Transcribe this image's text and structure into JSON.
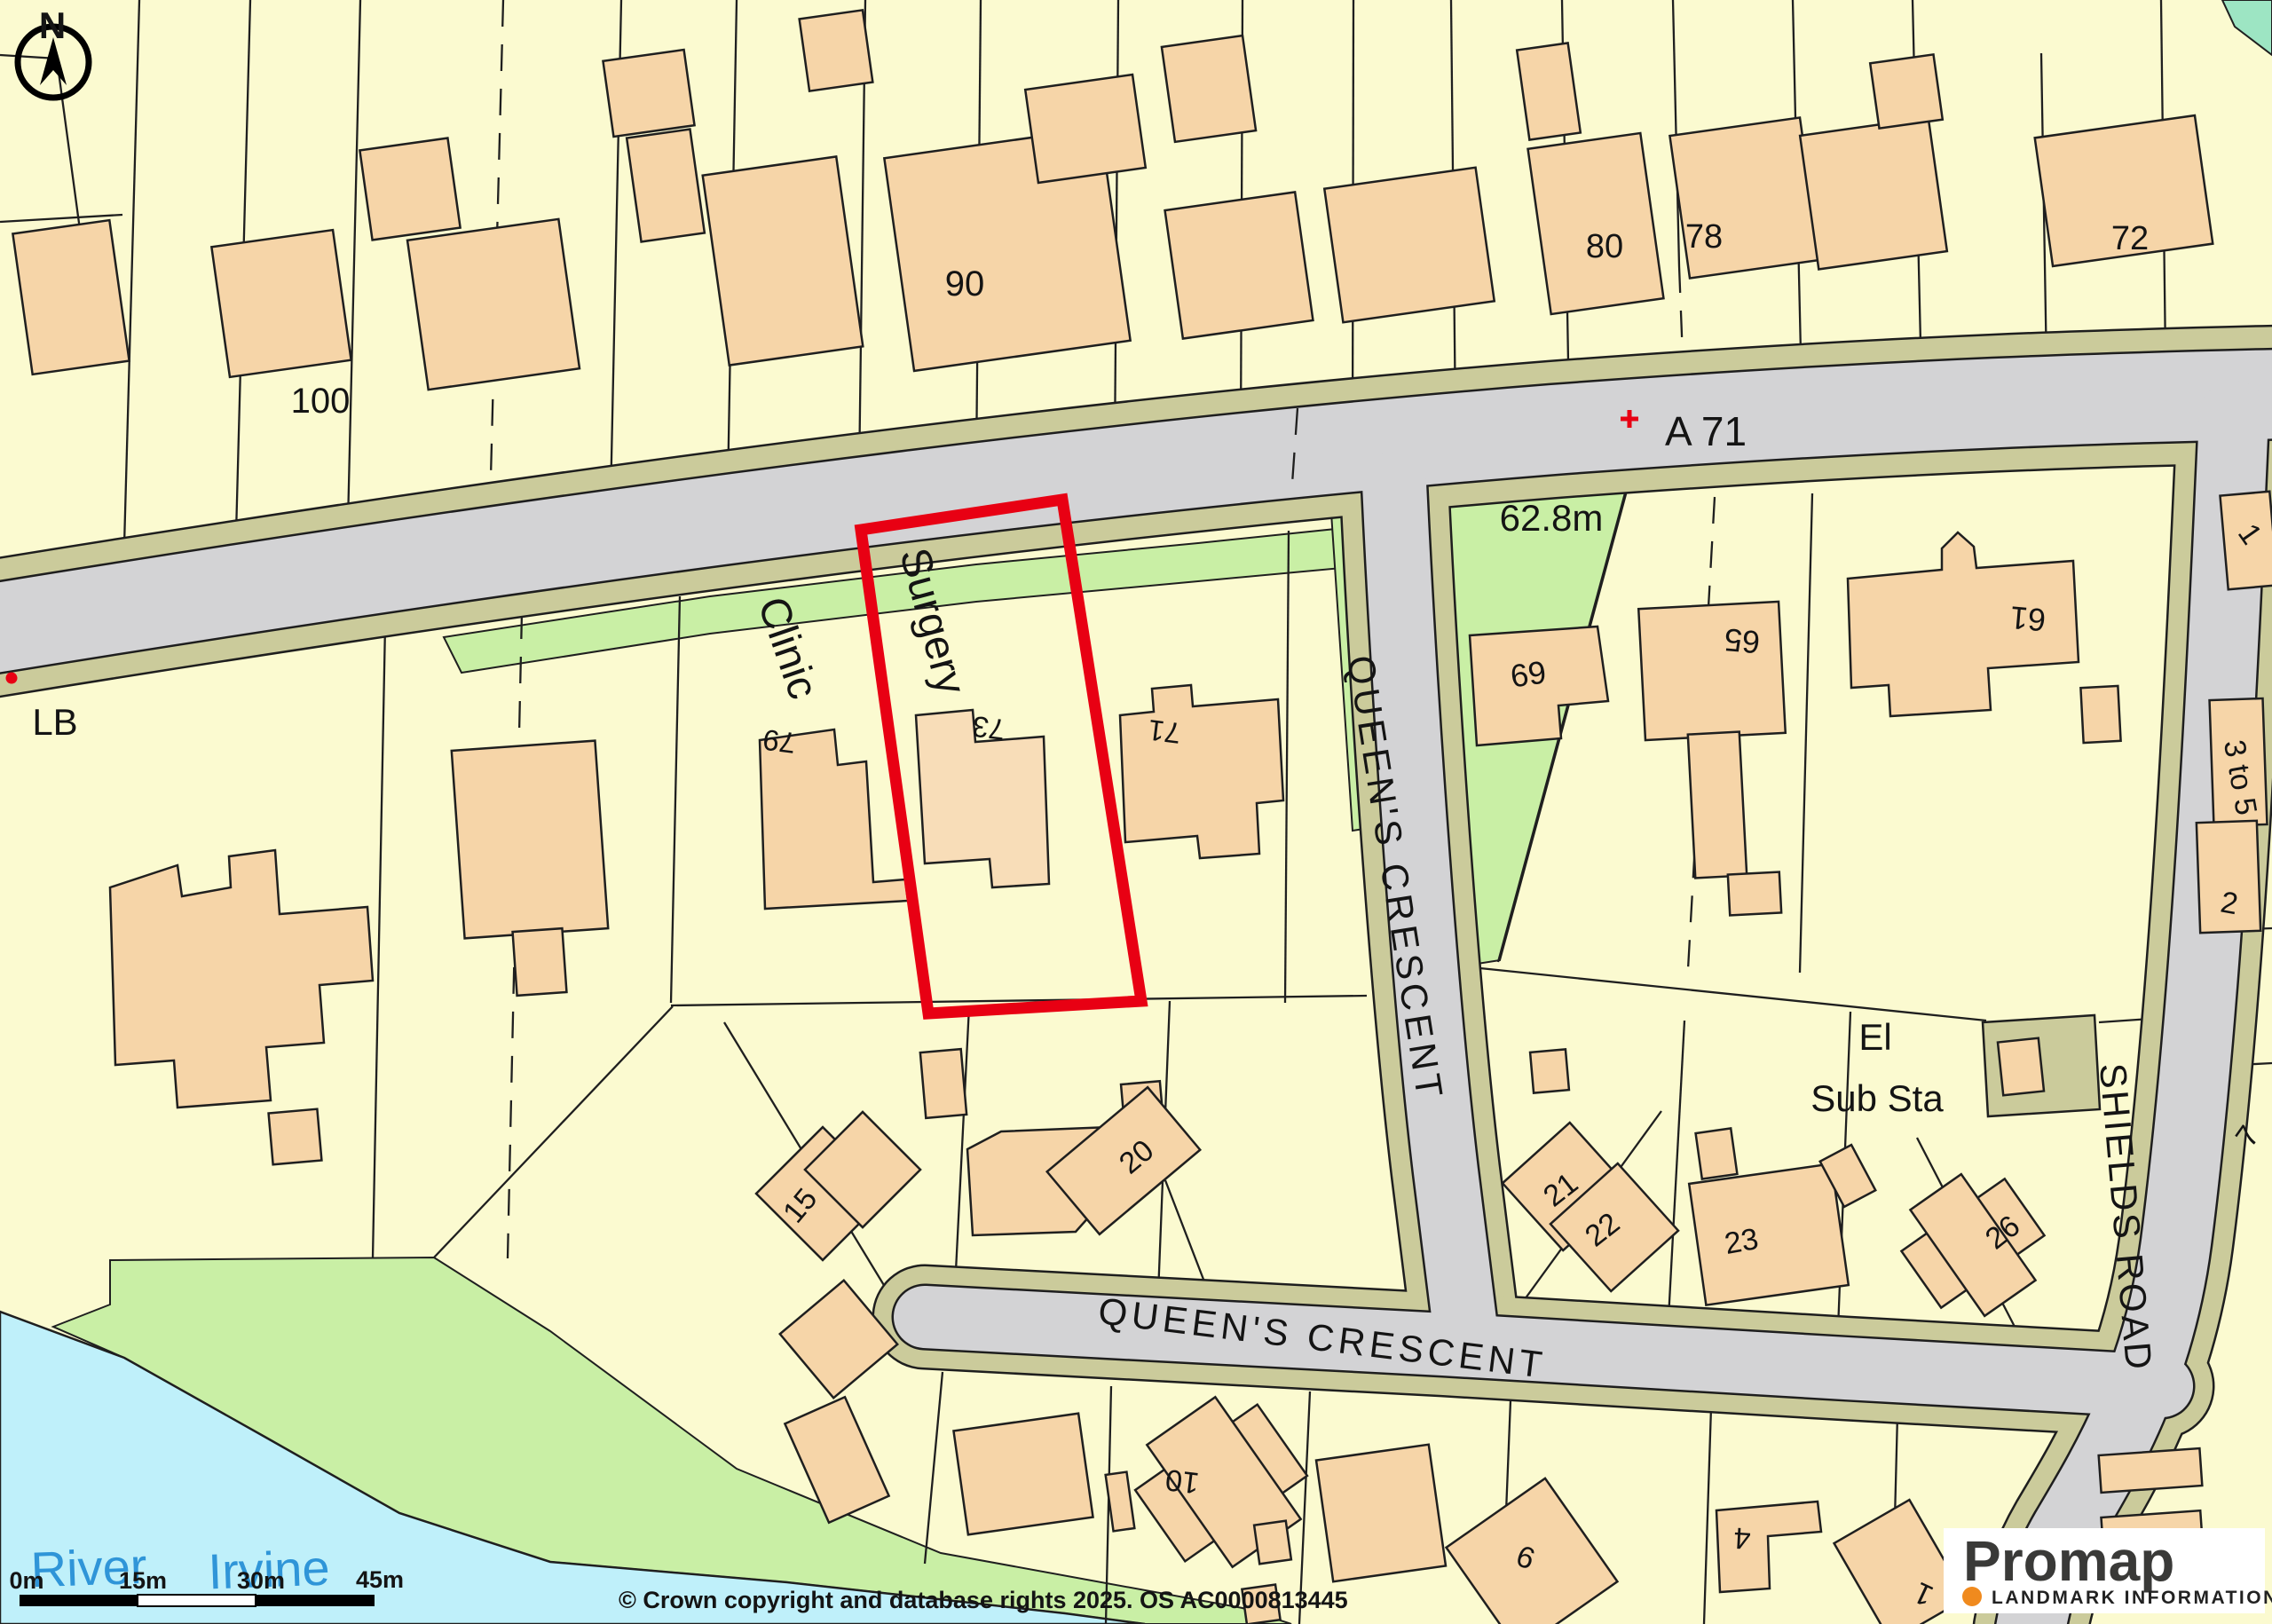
{
  "compass": {
    "north": "N"
  },
  "roads": {
    "a71": "A 71",
    "queens_crescent_vertical": "QUEEN'S CRESCENT",
    "queens_crescent_horizontal": "QUEEN'S CRESCENT",
    "shields_road": "SHIELDS ROAD"
  },
  "features": {
    "clinic": "Clinic",
    "surgery": "Surgery",
    "lb": "LB",
    "el": "El",
    "sub_sta": "Sub Sta",
    "spot_height": "62.8m",
    "river_word1": "River",
    "river_word2": "Irvine"
  },
  "plots": {
    "n100": "100",
    "n90": "90",
    "n80": "80",
    "n78": "78",
    "n72": "72",
    "n79": "79",
    "n73": "73",
    "n71": "71",
    "n69": "69",
    "n65": "65",
    "n61": "61",
    "n1_ne": "1",
    "n3to5": "3 to 5",
    "n2": "2",
    "n15": "15",
    "n20": "20",
    "n21": "21",
    "n22": "22",
    "n23": "23",
    "n26": "26",
    "n7": "7",
    "n10": "10",
    "n9": "9",
    "n4": "4",
    "n1_s": "1"
  },
  "scale_bar": {
    "t0": "0m",
    "t15": "15m",
    "t30": "30m",
    "t45": "45m"
  },
  "footer": {
    "copyright": "© Crown copyright and database rights 2025. OS AC0000813445"
  },
  "logo": {
    "brand": "Promap",
    "tagline": "LANDMARK INFORMATION"
  },
  "highlight": {
    "boundary_color": "#e80013"
  },
  "colors": {
    "parcel": "#fbfad0",
    "building": "#f6d5a8",
    "road": "#d3d3d5",
    "verge": "#cbcb9b",
    "green": "#c9efa5",
    "water": "#bff0fa",
    "teal": "#9de5c3",
    "river_text": "#2f95d8",
    "logo_orange": "#f08a1e"
  }
}
